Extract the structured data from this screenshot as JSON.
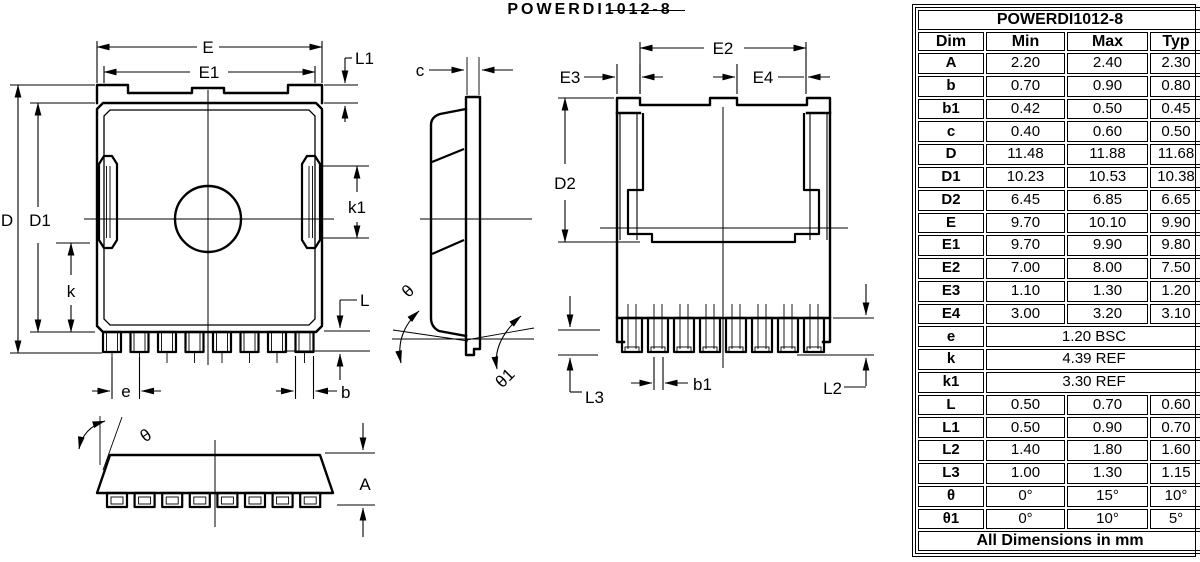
{
  "drawing_title": "POWERDI1012-8",
  "views": {
    "front": {
      "e": "E",
      "e1": "E1",
      "l1": "L1",
      "d": "D",
      "d1": "D1",
      "k": "k",
      "k1": "k1",
      "l": "L",
      "pitch": "e",
      "b": "b"
    },
    "side": {
      "c": "c",
      "theta": "θ",
      "theta1": "θ1"
    },
    "back": {
      "e2": "E2",
      "e3": "E3",
      "e4": "E4",
      "d2": "D2",
      "b1": "b1",
      "l2": "L2",
      "l3": "L3"
    },
    "bottom": {
      "theta": "θ",
      "a": "A"
    }
  },
  "table": {
    "title": "POWERDI1012-8",
    "columns": [
      "Dim",
      "Min",
      "Max",
      "Typ"
    ],
    "rows": [
      {
        "dim": "A",
        "min": "2.20",
        "max": "2.40",
        "typ": "2.30"
      },
      {
        "dim": "b",
        "min": "0.70",
        "max": "0.90",
        "typ": "0.80"
      },
      {
        "dim": "b1",
        "min": "0.42",
        "max": "0.50",
        "typ": "0.45"
      },
      {
        "dim": "c",
        "min": "0.40",
        "max": "0.60",
        "typ": "0.50"
      },
      {
        "dim": "D",
        "min": "11.48",
        "max": "11.88",
        "typ": "11.68"
      },
      {
        "dim": "D1",
        "min": "10.23",
        "max": "10.53",
        "typ": "10.38"
      },
      {
        "dim": "D2",
        "min": "6.45",
        "max": "6.85",
        "typ": "6.65"
      },
      {
        "dim": "E",
        "min": "9.70",
        "max": "10.10",
        "typ": "9.90"
      },
      {
        "dim": "E1",
        "min": "9.70",
        "max": "9.90",
        "typ": "9.80"
      },
      {
        "dim": "E2",
        "min": "7.00",
        "max": "8.00",
        "typ": "7.50"
      },
      {
        "dim": "E3",
        "min": "1.10",
        "max": "1.30",
        "typ": "1.20"
      },
      {
        "dim": "E4",
        "min": "3.00",
        "max": "3.20",
        "typ": "3.10"
      },
      {
        "dim": "e",
        "span": "1.20 BSC"
      },
      {
        "dim": "k",
        "span": "4.39 REF"
      },
      {
        "dim": "k1",
        "span": "3.30 REF"
      },
      {
        "dim": "L",
        "min": "0.50",
        "max": "0.70",
        "typ": "0.60"
      },
      {
        "dim": "L1",
        "min": "0.50",
        "max": "0.90",
        "typ": "0.70"
      },
      {
        "dim": "L2",
        "min": "1.40",
        "max": "1.80",
        "typ": "1.60"
      },
      {
        "dim": "L3",
        "min": "1.00",
        "max": "1.30",
        "typ": "1.15"
      },
      {
        "dim": "θ",
        "min": "0°",
        "max": "15°",
        "typ": "10°"
      },
      {
        "dim": "θ1",
        "min": "0°",
        "max": "10°",
        "typ": "5°"
      }
    ],
    "footer": "All Dimensions in mm"
  },
  "colors": {
    "line": "#000000",
    "background": "#ffffff",
    "text": "#000000"
  }
}
